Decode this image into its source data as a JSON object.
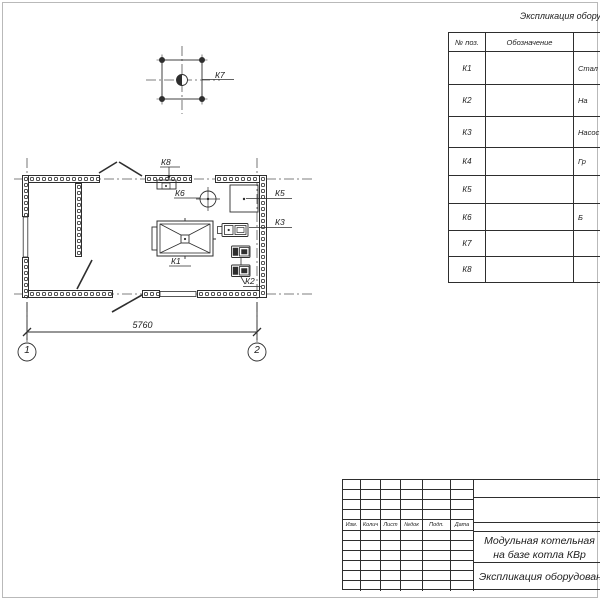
{
  "plan": {
    "labels": {
      "k1": "К1",
      "k2": "К2",
      "k3": "К3",
      "k5": "К5",
      "k6": "К6",
      "k7": "К7",
      "k8": "К8"
    },
    "dimension": "5760",
    "axes": [
      "1",
      "2"
    ]
  },
  "equip_table": {
    "title": "Экспликация оборудования",
    "headers": {
      "pos": "№ поз.",
      "designation": "Обозначение",
      "name": ""
    },
    "rows": [
      {
        "pos": "К1",
        "designation": "",
        "name": "Стал"
      },
      {
        "pos": "К2",
        "designation": "",
        "name": "На"
      },
      {
        "pos": "К3",
        "designation": "",
        "name": "Насос"
      },
      {
        "pos": "К4",
        "designation": "",
        "name": "Гр"
      },
      {
        "pos": "К5",
        "designation": "",
        "name": ""
      },
      {
        "pos": "К6",
        "designation": "",
        "name": "Б"
      },
      {
        "pos": "К7",
        "designation": "",
        "name": ""
      },
      {
        "pos": "К8",
        "designation": "",
        "name": ""
      }
    ]
  },
  "title_block": {
    "columns": [
      "Изм.",
      "Колич",
      "Лист",
      "№док",
      "Подп.",
      "Дата"
    ],
    "project_title_line1": "Модульная котельная",
    "project_title_line2": "на базе котла КВр",
    "sheet_title": "Экспликация оборудования"
  },
  "colors": {
    "line": "#2e2e2e",
    "axis": "#555555",
    "frame": "#b9b9b9"
  }
}
